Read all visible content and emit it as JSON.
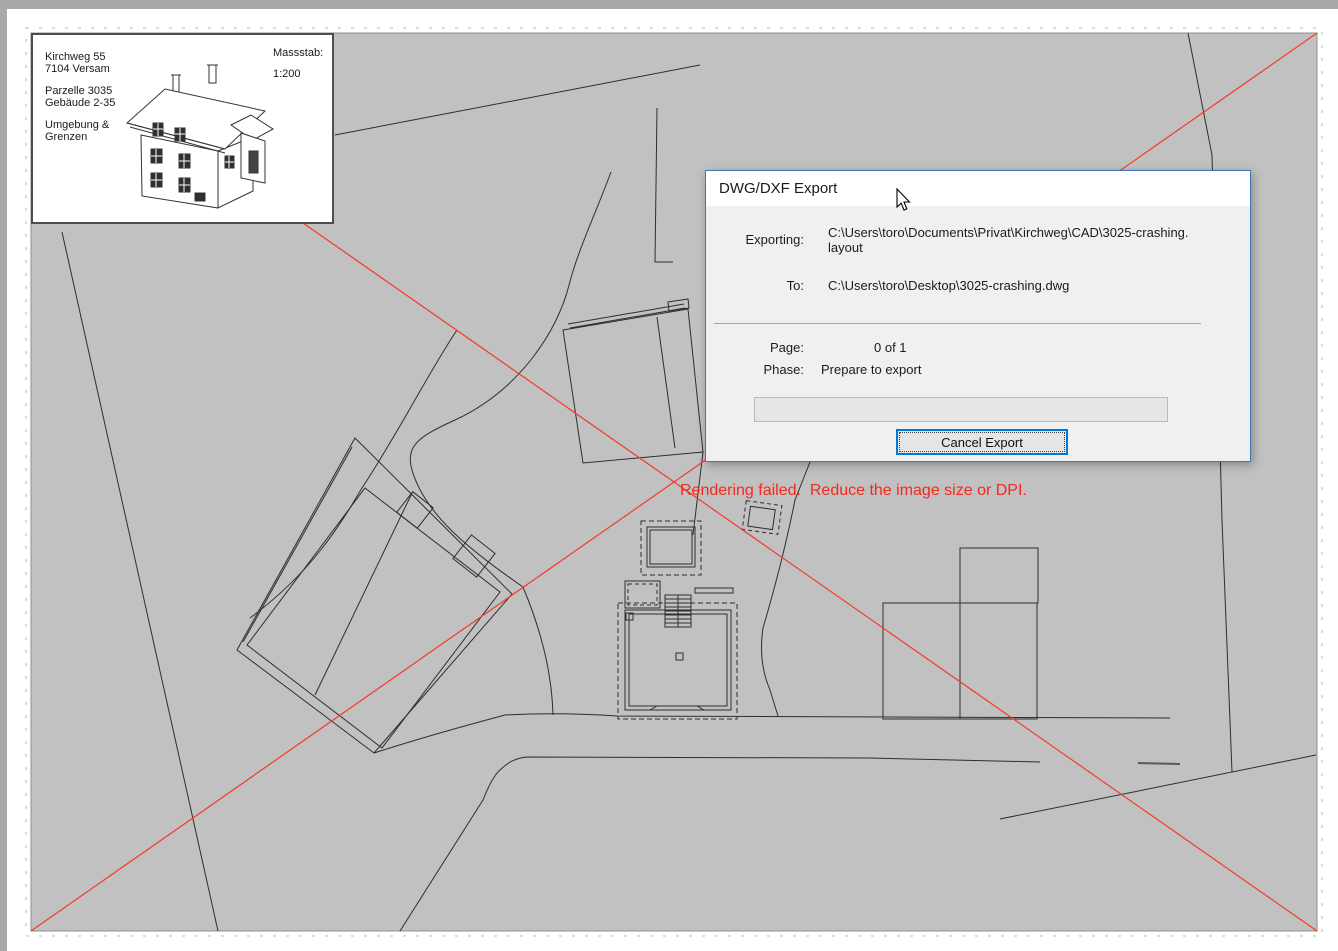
{
  "window": {
    "frame_color": "#a9a9a9",
    "canvas_bg": "#ffffff",
    "page_bg": "#c1c1c1"
  },
  "title_block": {
    "line1": "Kirchweg 55",
    "line2": "7104 Versam",
    "line3": "Parzelle 3035",
    "line4": "Gebäude 2-35",
    "line5": "Umgebung &",
    "line6": "Grenzen",
    "scale_label": "Massstab:",
    "scale_value": "1:200"
  },
  "canvas": {
    "error_message": "Rendering failed.  Reduce the image size or DPI.",
    "error_color": "#f5281c",
    "failure_marker_color": "#f43a2a"
  },
  "dialog": {
    "title": "DWG/DXF Export",
    "exporting_label": "Exporting:",
    "exporting_value_line1": "C:\\Users\\toro\\Documents\\Privat\\Kirchweg\\CAD\\3025-crashing.",
    "exporting_value_line2": "layout",
    "to_label": "To:",
    "to_value": "C:\\Users\\toro\\Desktop\\3025-crashing.dwg",
    "page_label": "Page:",
    "page_value": "0 of 1",
    "phase_label": "Phase:",
    "phase_value": "Prepare to export",
    "progress_percent": 0,
    "cancel_button_label": "Cancel Export",
    "border_color": "#3f74b5",
    "button_focus_color": "#0078d7"
  }
}
